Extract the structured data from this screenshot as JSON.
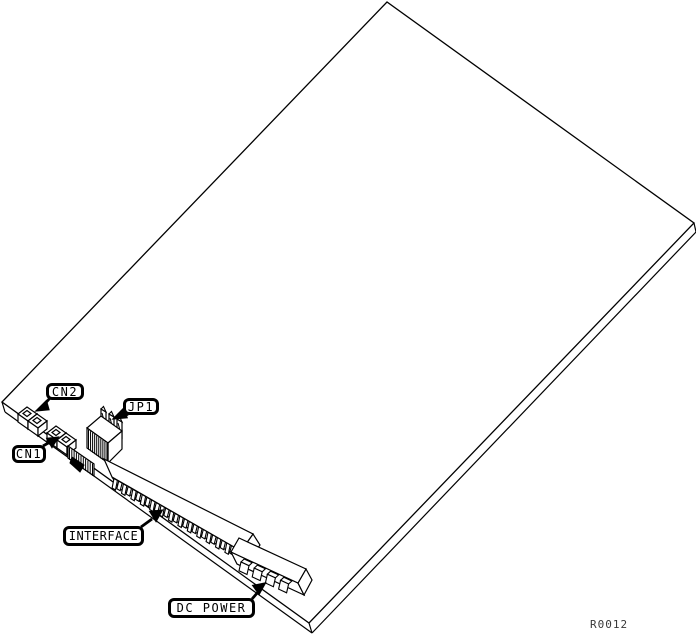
{
  "figure": {
    "kind": "pcb-line-drawing",
    "callouts": [
      {
        "id": "cn2",
        "label": "CN2"
      },
      {
        "id": "jp1",
        "label": "JP1"
      },
      {
        "id": "cn1",
        "label": "CN1"
      },
      {
        "id": "interface",
        "label": "INTERFACE"
      },
      {
        "id": "dc_power",
        "label": "DC POWER"
      }
    ],
    "reference": "R0012",
    "colors": {
      "background": "#ffffff",
      "line": "#000000",
      "reference_text": "#383838"
    }
  }
}
